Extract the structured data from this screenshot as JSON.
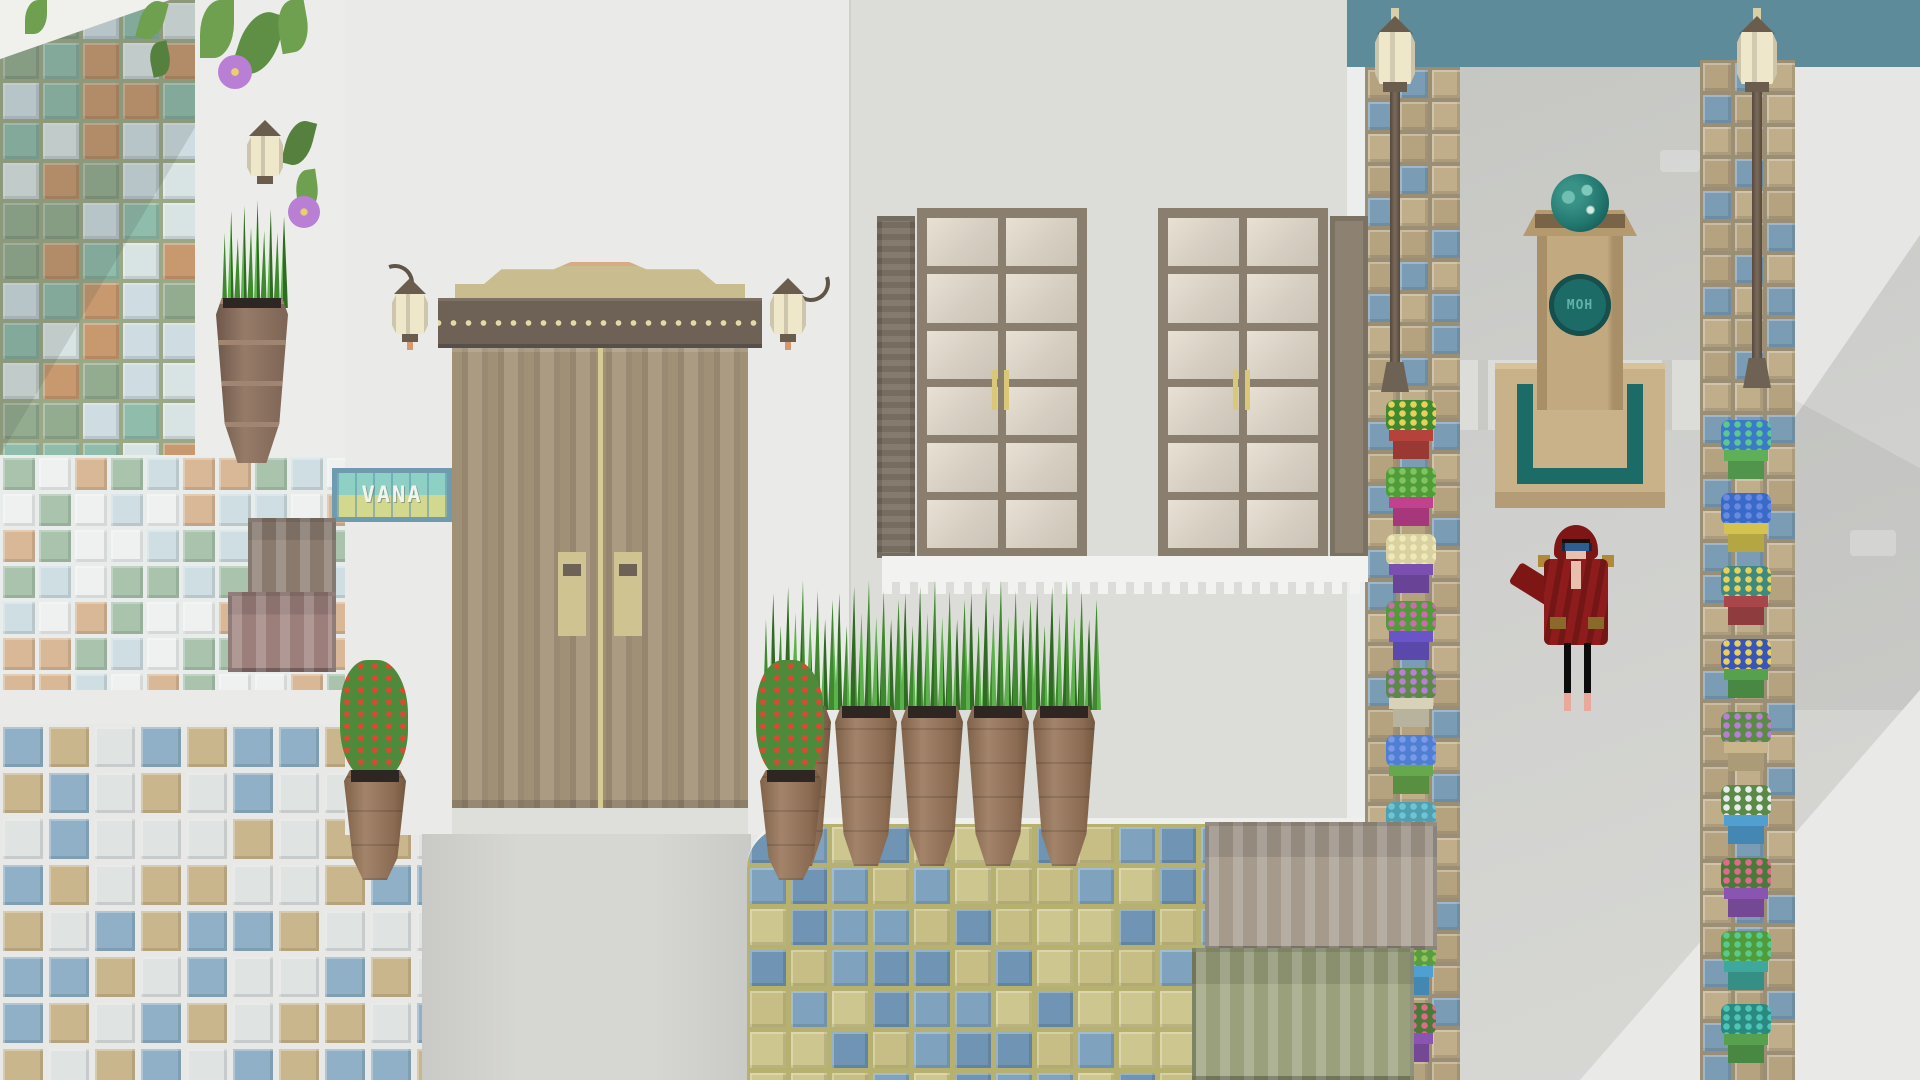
{
  "sign": {
    "text": "VANA"
  },
  "monument": {
    "emblem_text": "MOH"
  },
  "colors": {
    "bg": "#e7e8e5",
    "sea": "#5d8b99",
    "wall_light": "#ececea",
    "wall_door_building": "#eaeae8",
    "wall_window_building": "#dcddd9",
    "street": "#cfd0cd",
    "street_dark": "#c2c3bf",
    "door_wood": "#a09076",
    "door_lintel": "#6e6257",
    "door_dots": "#e5daa6",
    "door_trim": "#c9bd8f",
    "handle": "#cfc391",
    "window_frame": "#8a7f6f",
    "pane": "#d7d0c3",
    "shutter": "#7d7365",
    "lamp_body": "#efe7c9",
    "lamp_cap": "#6b5d4e",
    "monument_stone": "#c3a97f",
    "monument_teal": "#1d6b66",
    "monument_text_color": "#5fb3a9",
    "npc_robe": "#8f1c1c",
    "npc_hood": "#7e1616",
    "npc_visor": "#2e5d92",
    "npc_gold": "#b08a3a",
    "npc_skin": "#e9c0ad",
    "sign_border": "#6f9ab0",
    "sign_tile_top": "#8fd0c5",
    "sign_tile_bottom": "#d2d88e",
    "sign_text_color": "#f2f4ec",
    "terracotta_pot": "#9c7a5d",
    "grass_green": "#4f9c38",
    "vine_green": "#6fa04f",
    "flower_purple": "#b87fd4"
  },
  "tiles": {
    "mosaic": {
      "colors": [
        "#c8986f",
        "#93ac8f",
        "#cfdde2",
        "#8fbcab",
        "#d8e4e4"
      ],
      "grout": "#9aa885",
      "gap": "4px"
    },
    "band": {
      "colors": [
        "#c8986f",
        "#93ac8f",
        "#dfe7e6",
        "#8fbcab"
      ],
      "grout": "#9aa885",
      "gap": "4px"
    },
    "band2": {
      "colors": [
        "#8fbcab",
        "#c8986f",
        "#dfe7e6"
      ],
      "grout": "#8aa08a",
      "gap": "3px"
    },
    "fine": {
      "colors": [
        "#cfdee3",
        "#eef1f0",
        "#d9b897",
        "#a9c3ad"
      ],
      "grout": "#e8ecea",
      "gap": "4px"
    },
    "floor": {
      "colors": [
        "#8fb0c6",
        "#c9b68c",
        "#dfe3e2"
      ],
      "grout": "#e8e9e6",
      "gap": "6px"
    },
    "patio": {
      "colors": [
        "#c6be85",
        "#7fa3bf",
        "#cdc68f",
        "#6f94b4"
      ],
      "grout": "#b7b16f",
      "gap": "5px"
    },
    "path": {
      "colors": [
        "#b5a27f",
        "#7b9cb5",
        "#c0ae8a"
      ],
      "grout": "#9a8f74",
      "gap": "4px"
    }
  },
  "strips": {
    "left": {
      "pots": [
        {
          "name": "yellow-daffodils",
          "pot": "#b5433c",
          "plant": "#3f8a2e",
          "bloom": "#e8d05a"
        },
        {
          "name": "green-fern",
          "pot": "#c2418f",
          "plant": "#4f9c38",
          "bloom": "#7fc45e"
        },
        {
          "name": "pale-cactus",
          "pot": "#7a4fb0",
          "plant": "#d9d2a0",
          "bloom": "#efe8b8"
        },
        {
          "name": "pink-dot-bush",
          "pot": "#6a55c8",
          "plant": "#4f9c38",
          "bloom": "#d06ab0"
        },
        {
          "name": "purple-cluster",
          "pot": "#d8d2b8",
          "plant": "#5a8a46",
          "bloom": "#b87fd4"
        },
        {
          "name": "blue-iris",
          "pot": "#67a84c",
          "plant": "#4f7fd1",
          "bloom": "#7a9ae8"
        },
        {
          "name": "teal-spikes",
          "pot": "#c9b944",
          "plant": "#4f9fb0",
          "bloom": "#6fc4d4"
        },
        {
          "name": "teal-dot-bush",
          "pot": "#b5494c",
          "plant": "#3f8a80",
          "bloom": "#e8d05a"
        },
        {
          "name": "mini-tree",
          "pot": "#4f9fd1",
          "plant": "#5a9c3f",
          "bloom": "#8fc45e"
        },
        {
          "name": "pink-tulips",
          "pot": "#8a55b0",
          "plant": "#4a7a3a",
          "bloom": "#e06a8a"
        }
      ]
    },
    "right": {
      "pots": [
        {
          "name": "blue-green-sprout",
          "pot": "#5fae58",
          "plant": "#3a7ac8",
          "bloom": "#5ac88f"
        },
        {
          "name": "blue-iris",
          "pot": "#d4c44f",
          "plant": "#3a6ac8",
          "bloom": "#6a8ae0"
        },
        {
          "name": "teal-dot-bush",
          "pot": "#a8464a",
          "plant": "#3f8a80",
          "bloom": "#e8d05a"
        },
        {
          "name": "blue-dot-bush",
          "pot": "#56a04e",
          "plant": "#3a55b8",
          "bloom": "#e8d05a"
        },
        {
          "name": "purple-cluster",
          "pot": "#c9b68c",
          "plant": "#5a8a46",
          "bloom": "#b87fd4"
        },
        {
          "name": "white-blossoms",
          "pot": "#4f9fd1",
          "plant": "#5a8a46",
          "bloom": "#e8ecf0"
        },
        {
          "name": "pink-tulips",
          "pot": "#8a55b0",
          "plant": "#4a7a3a",
          "bloom": "#e06a8a"
        },
        {
          "name": "green-shrub",
          "pot": "#3fa89c",
          "plant": "#4f9c38",
          "bloom": "#5ac88f"
        },
        {
          "name": "teal-bloom",
          "pot": "#56a04e",
          "plant": "#2a8a80",
          "bloom": "#4fc4b8"
        }
      ]
    }
  }
}
